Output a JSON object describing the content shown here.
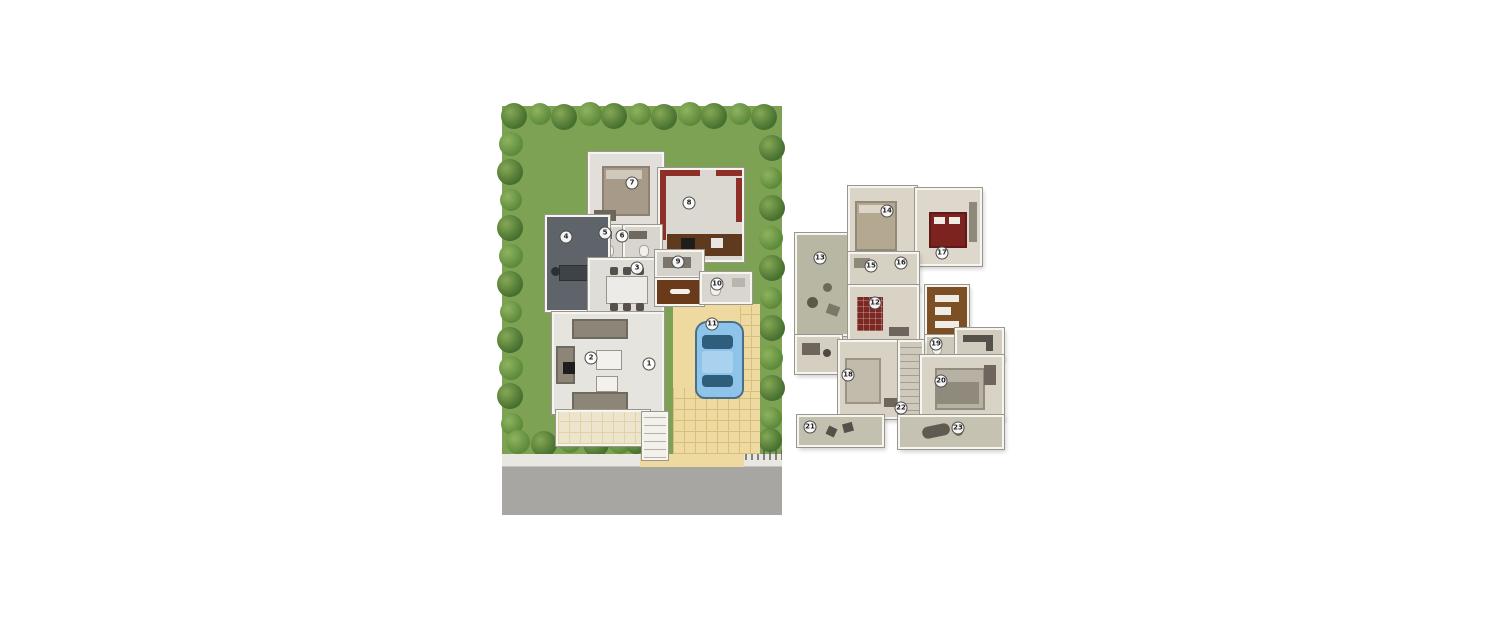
{
  "canvas": {
    "width": 1500,
    "height": 625,
    "background": "#ffffff"
  },
  "plans": [
    {
      "id": "site-plan-ground-floor",
      "description": "ground floor villa plan with landscaped garden, driveway, car and road",
      "markers": [
        {
          "n": "1",
          "x": 147,
          "y": 258
        },
        {
          "n": "2",
          "x": 89,
          "y": 252
        },
        {
          "n": "3",
          "x": 135,
          "y": 162
        },
        {
          "n": "4",
          "x": 64,
          "y": 131
        },
        {
          "n": "5",
          "x": 103,
          "y": 127
        },
        {
          "n": "6",
          "x": 120,
          "y": 130
        },
        {
          "n": "7",
          "x": 130,
          "y": 77
        },
        {
          "n": "8",
          "x": 187,
          "y": 97
        },
        {
          "n": "9",
          "x": 176,
          "y": 156
        },
        {
          "n": "10",
          "x": 215,
          "y": 178
        },
        {
          "n": "11",
          "x": 210,
          "y": 218
        }
      ],
      "palette": {
        "lawn": "#7da253",
        "tree_dark": "#46702f",
        "tree_mid": "#5c8a3a",
        "road": "#a8a6a2",
        "sidewalk": "#e9e7e1",
        "driveway": "#eed9a0",
        "wall": "#f7f5f0",
        "floor": "#e0ddd7",
        "accent_red": "#8e3028",
        "wood_brown": "#6b3a1a",
        "study_gray": "#5f646a",
        "car_blue": "#8ec4ea",
        "car_glass": "#2f5d7c",
        "porch": "#ece4cc"
      }
    },
    {
      "id": "first-floor-plan",
      "description": "upper floor apartment plan with bedrooms, terraces and balconies",
      "markers": [
        {
          "n": "12",
          "x": 82,
          "y": 120
        },
        {
          "n": "13",
          "x": 27,
          "y": 75
        },
        {
          "n": "14",
          "x": 94,
          "y": 28
        },
        {
          "n": "15",
          "x": 78,
          "y": 83
        },
        {
          "n": "16",
          "x": 108,
          "y": 80
        },
        {
          "n": "17",
          "x": 149,
          "y": 70
        },
        {
          "n": "18",
          "x": 55,
          "y": 192
        },
        {
          "n": "19",
          "x": 143,
          "y": 161
        },
        {
          "n": "20",
          "x": 148,
          "y": 198
        },
        {
          "n": "21",
          "x": 17,
          "y": 244
        },
        {
          "n": "22",
          "x": 108,
          "y": 225
        },
        {
          "n": "23",
          "x": 165,
          "y": 245
        }
      ],
      "palette": {
        "floor": "#d9d4c6",
        "terrace": "#b7b7a3",
        "kitchen_brown": "#7d4f24",
        "bed_red": "#7c2320",
        "wall": "#f7f5f0",
        "balcony": "#c4c0af",
        "rug_red": "#7c2822"
      }
    }
  ],
  "site": {
    "trees": [
      {
        "x": 12,
        "y": 10,
        "r": 13,
        "s": 0
      },
      {
        "x": 38,
        "y": 8,
        "r": 11,
        "s": 1
      },
      {
        "x": 62,
        "y": 11,
        "r": 13,
        "s": 0
      },
      {
        "x": 88,
        "y": 8,
        "r": 12,
        "s": 1
      },
      {
        "x": 112,
        "y": 10,
        "r": 13,
        "s": 0
      },
      {
        "x": 138,
        "y": 8,
        "r": 11,
        "s": 1
      },
      {
        "x": 162,
        "y": 11,
        "r": 13,
        "s": 0
      },
      {
        "x": 188,
        "y": 8,
        "r": 12,
        "s": 1
      },
      {
        "x": 212,
        "y": 10,
        "r": 13,
        "s": 0
      },
      {
        "x": 238,
        "y": 8,
        "r": 11,
        "s": 1
      },
      {
        "x": 262,
        "y": 11,
        "r": 13,
        "s": 0
      },
      {
        "x": 9,
        "y": 38,
        "r": 12,
        "s": 1
      },
      {
        "x": 8,
        "y": 66,
        "r": 13,
        "s": 0
      },
      {
        "x": 9,
        "y": 94,
        "r": 11,
        "s": 1
      },
      {
        "x": 8,
        "y": 122,
        "r": 13,
        "s": 0
      },
      {
        "x": 9,
        "y": 150,
        "r": 12,
        "s": 1
      },
      {
        "x": 8,
        "y": 178,
        "r": 13,
        "s": 0
      },
      {
        "x": 9,
        "y": 206,
        "r": 11,
        "s": 1
      },
      {
        "x": 8,
        "y": 234,
        "r": 13,
        "s": 0
      },
      {
        "x": 9,
        "y": 262,
        "r": 12,
        "s": 1
      },
      {
        "x": 8,
        "y": 290,
        "r": 13,
        "s": 0
      },
      {
        "x": 10,
        "y": 318,
        "r": 11,
        "s": 1
      },
      {
        "x": 270,
        "y": 42,
        "r": 13,
        "s": 0
      },
      {
        "x": 269,
        "y": 72,
        "r": 11,
        "s": 1
      },
      {
        "x": 270,
        "y": 102,
        "r": 13,
        "s": 0
      },
      {
        "x": 269,
        "y": 132,
        "r": 12,
        "s": 1
      },
      {
        "x": 270,
        "y": 162,
        "r": 13,
        "s": 0
      },
      {
        "x": 269,
        "y": 192,
        "r": 11,
        "s": 1
      },
      {
        "x": 270,
        "y": 222,
        "r": 13,
        "s": 0
      },
      {
        "x": 269,
        "y": 252,
        "r": 12,
        "s": 1
      },
      {
        "x": 270,
        "y": 282,
        "r": 13,
        "s": 0
      },
      {
        "x": 269,
        "y": 312,
        "r": 11,
        "s": 1
      },
      {
        "x": 268,
        "y": 334,
        "r": 12,
        "s": 0
      },
      {
        "x": 16,
        "y": 336,
        "r": 12,
        "s": 1
      },
      {
        "x": 42,
        "y": 338,
        "r": 13,
        "s": 0
      },
      {
        "x": 68,
        "y": 336,
        "r": 11,
        "s": 1
      },
      {
        "x": 94,
        "y": 338,
        "r": 13,
        "s": 0
      },
      {
        "x": 118,
        "y": 336,
        "r": 12,
        "s": 1
      },
      {
        "x": 134,
        "y": 338,
        "r": 10,
        "s": 0
      }
    ]
  }
}
